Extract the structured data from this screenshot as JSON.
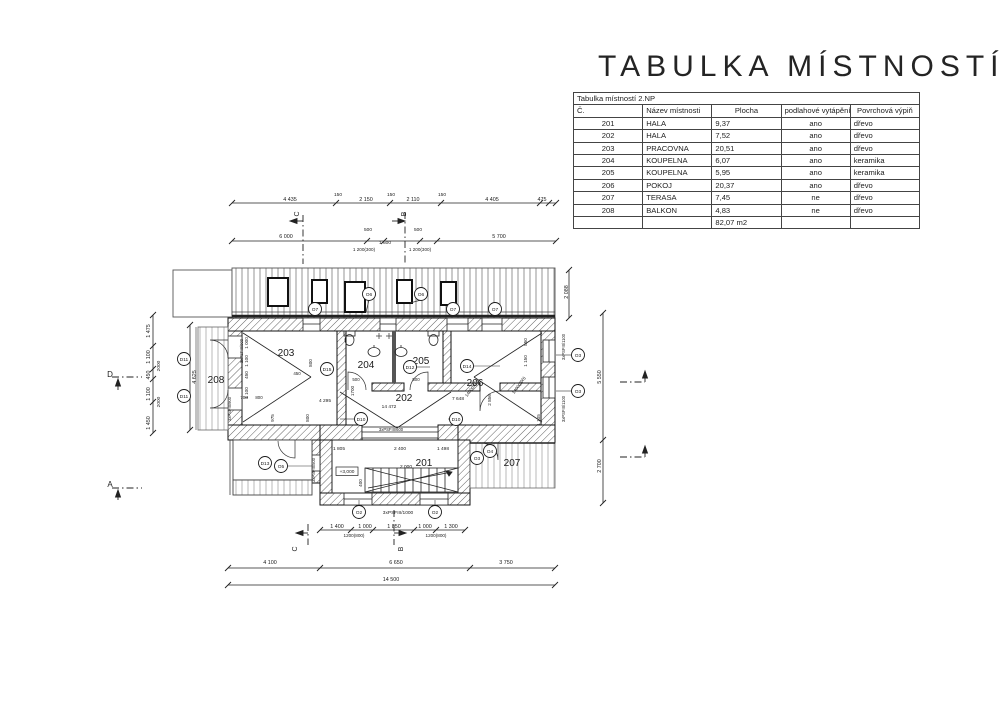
{
  "title": "TABULKA MÍSTNOSTÍ",
  "table": {
    "caption": "Tabulka místností 2.NP",
    "columns": [
      "Č.",
      "Název místnosti",
      "Plocha",
      "podlahové vytápění",
      "Povrchová výpiň"
    ],
    "rows": [
      [
        "201",
        "HALA",
        "9,37",
        "ano",
        "dřevo"
      ],
      [
        "202",
        "HALA",
        "7,52",
        "ano",
        "dřevo"
      ],
      [
        "203",
        "PRACOVNA",
        "20,51",
        "ano",
        "dřevo"
      ],
      [
        "204",
        "KOUPELNA",
        "6,07",
        "ano",
        "keramika"
      ],
      [
        "205",
        "KOUPELNA",
        "5,95",
        "ano",
        "keramika"
      ],
      [
        "206",
        "POKOJ",
        "20,37",
        "ano",
        "dřevo"
      ],
      [
        "207",
        "TERASA",
        "7,45",
        "ne",
        "dřevo"
      ],
      [
        "208",
        "BALKON",
        "4,83",
        "ne",
        "dřevo"
      ]
    ],
    "total": "82,07 m2"
  },
  "colors": {
    "highlight": "#e56fce",
    "ink": "#1a1a1a"
  },
  "plan": {
    "room_labels": [
      {
        "t": "201",
        "x": 424,
        "y": 466,
        "s": 10
      },
      {
        "t": "202",
        "x": 404,
        "y": 401,
        "s": 10
      },
      {
        "t": "203",
        "x": 286,
        "y": 356,
        "s": 10
      },
      {
        "t": "204",
        "x": 366,
        "y": 368,
        "s": 10
      },
      {
        "t": "205",
        "x": 421,
        "y": 364,
        "s": 10
      },
      {
        "t": "206",
        "x": 475,
        "y": 386,
        "s": 10
      },
      {
        "t": "207",
        "x": 512,
        "y": 466,
        "s": 10
      },
      {
        "t": "208",
        "x": 216,
        "y": 383,
        "s": 10
      }
    ],
    "labels": [
      {
        "t": "4 435",
        "x": 290,
        "y": 201
      },
      {
        "t": "150",
        "x": 338,
        "y": 196,
        "s": 4.8
      },
      {
        "t": "2 150",
        "x": 366,
        "y": 201
      },
      {
        "t": "150",
        "x": 391,
        "y": 196,
        "s": 4.8
      },
      {
        "t": "2 110",
        "x": 413,
        "y": 201
      },
      {
        "t": "150",
        "x": 442,
        "y": 196,
        "s": 4.8
      },
      {
        "t": "4 405",
        "x": 492,
        "y": 201
      },
      {
        "t": "475",
        "x": 542,
        "y": 201
      },
      {
        "t": "6 000",
        "x": 286,
        "y": 238
      },
      {
        "t": "500",
        "x": 368,
        "y": 231,
        "s": 4.8
      },
      {
        "t": "1 600",
        "x": 385,
        "y": 244,
        "s": 4.8
      },
      {
        "t": "500",
        "x": 418,
        "y": 231,
        "s": 4.8
      },
      {
        "t": "5 700",
        "x": 499,
        "y": 238
      },
      {
        "t": "1 200(300)",
        "x": 364,
        "y": 251,
        "s": 4.6
      },
      {
        "t": "1 200(300)",
        "x": 420,
        "y": 251,
        "s": 4.6
      },
      {
        "t": "C",
        "x": 299,
        "y": 214,
        "s": 7,
        "r": -90
      },
      {
        "t": "B",
        "x": 406,
        "y": 214,
        "s": 7,
        "r": -90
      },
      {
        "t": "C",
        "x": 297,
        "y": 549,
        "s": 7,
        "r": -90
      },
      {
        "t": "B",
        "x": 403,
        "y": 549,
        "s": 7,
        "r": -90
      },
      {
        "t": "D",
        "x": 110,
        "y": 377,
        "s": 8
      },
      {
        "t": "A",
        "x": 110,
        "y": 487,
        "s": 8
      },
      {
        "t": "1 475",
        "x": 150,
        "y": 331,
        "r": -90
      },
      {
        "t": "1 100",
        "x": 150,
        "y": 357,
        "r": -90
      },
      {
        "t": "450",
        "x": 150,
        "y": 375,
        "r": -90
      },
      {
        "t": "1 100",
        "x": 150,
        "y": 394,
        "r": -90
      },
      {
        "t": "1 450",
        "x": 150,
        "y": 423,
        "r": -90
      },
      {
        "t": "2000",
        "x": 160,
        "y": 366,
        "r": -90,
        "s": 4.8
      },
      {
        "t": "2000",
        "x": 160,
        "y": 402,
        "r": -90,
        "s": 4.8
      },
      {
        "t": "4 625",
        "x": 196,
        "y": 377,
        "r": -90
      },
      {
        "t": "2 088",
        "x": 568,
        "y": 292,
        "r": -90
      },
      {
        "t": "5 550",
        "x": 601,
        "y": 377,
        "r": -90
      },
      {
        "t": "2 700",
        "x": 601,
        "y": 466,
        "r": -90
      },
      {
        "t": "1 805",
        "x": 339,
        "y": 450,
        "s": 4.8
      },
      {
        "t": "2 400",
        "x": 400,
        "y": 450,
        "s": 4.8
      },
      {
        "t": "1 498",
        "x": 443,
        "y": 450,
        "s": 4.8
      },
      {
        "t": "2 000",
        "x": 406,
        "y": 468,
        "s": 4.8
      },
      {
        "t": "400",
        "x": 362,
        "y": 483,
        "r": -90,
        "s": 4.6
      },
      {
        "t": "+3,000",
        "x": 347,
        "y": 473,
        "s": 4.8
      },
      {
        "t": "1 400",
        "x": 337,
        "y": 528
      },
      {
        "t": "1 000",
        "x": 365,
        "y": 528
      },
      {
        "t": "1 850",
        "x": 394,
        "y": 528
      },
      {
        "t": "1 000",
        "x": 425,
        "y": 528
      },
      {
        "t": "1 300",
        "x": 451,
        "y": 528
      },
      {
        "t": "1200(800)",
        "x": 354,
        "y": 537,
        "s": 4.6
      },
      {
        "t": "1200(800)",
        "x": 436,
        "y": 537,
        "s": 4.6
      },
      {
        "t": "4 100",
        "x": 270,
        "y": 564
      },
      {
        "t": "6 650",
        "x": 396,
        "y": 564
      },
      {
        "t": "3 750",
        "x": 506,
        "y": 564
      },
      {
        "t": "14 500",
        "x": 391,
        "y": 581
      },
      {
        "t": "1 000",
        "x": 248,
        "y": 343,
        "r": -90,
        "s": 4.6
      },
      {
        "t": "1 100",
        "x": 248,
        "y": 361,
        "r": -90,
        "s": 4.6
      },
      {
        "t": "450",
        "x": 248,
        "y": 375,
        "r": -90,
        "s": 4.6
      },
      {
        "t": "1 100",
        "x": 248,
        "y": 393,
        "r": -90,
        "s": 4.6
      },
      {
        "t": "800",
        "x": 312,
        "y": 363,
        "r": -90,
        "s": 4.6
      },
      {
        "t": "450",
        "x": 297,
        "y": 375,
        "s": 4.4
      },
      {
        "t": "708",
        "x": 244,
        "y": 399,
        "s": 4.4
      },
      {
        "t": "800",
        "x": 259,
        "y": 399,
        "s": 4.4
      },
      {
        "t": "975",
        "x": 274,
        "y": 418,
        "r": -90,
        "s": 4.6
      },
      {
        "t": "800",
        "x": 309,
        "y": 418,
        "r": -90,
        "s": 4.6
      },
      {
        "t": "1700",
        "x": 354,
        "y": 391,
        "r": -90,
        "s": 4.6
      },
      {
        "t": "4 295",
        "x": 325,
        "y": 402,
        "s": 4.8
      },
      {
        "t": "14 472",
        "x": 389,
        "y": 408,
        "s": 4.8
      },
      {
        "t": "500",
        "x": 356,
        "y": 381,
        "s": 4.4
      },
      {
        "t": "500",
        "x": 416,
        "y": 381,
        "s": 4.4
      },
      {
        "t": "7 648",
        "x": 458,
        "y": 400,
        "s": 4.8
      },
      {
        "t": "2 856",
        "x": 491,
        "y": 400,
        "r": -90,
        "s": 4.6
      },
      {
        "t": "850",
        "x": 527,
        "y": 342,
        "r": -90,
        "s": 4.6
      },
      {
        "t": "1 150",
        "x": 527,
        "y": 361,
        "r": -90,
        "s": 4.6
      },
      {
        "t": "1400(800)",
        "x": 520,
        "y": 386,
        "r": -55,
        "s": 4.4
      },
      {
        "t": "1400(800)",
        "x": 473,
        "y": 389,
        "r": -55,
        "s": 4.4
      },
      {
        "t": "1 105",
        "x": 540,
        "y": 420,
        "r": -90,
        "s": 4.6
      },
      {
        "t": "3xPSFIII/900",
        "x": 243,
        "y": 351,
        "r": -90,
        "s": 4.2
      },
      {
        "t": "3xPSFIII/900",
        "x": 231,
        "y": 409,
        "r": -90,
        "s": 4.2
      },
      {
        "t": "3xPSFIII/1100",
        "x": 565,
        "y": 347,
        "r": -90,
        "s": 4.2
      },
      {
        "t": "3xPSFIII/1100",
        "x": 565,
        "y": 409,
        "r": -90,
        "s": 4.2
      },
      {
        "t": "3xPSFIII/500",
        "x": 315,
        "y": 470,
        "r": -90,
        "s": 4.2
      },
      {
        "t": "3xPSFIII/1000",
        "x": 398,
        "y": 514,
        "s": 4.8
      },
      {
        "t": "3xPSFIII/600",
        "x": 391,
        "y": 431,
        "s": 4.2
      }
    ],
    "circles": [
      {
        "t": "O7",
        "x": 315,
        "y": 309
      },
      {
        "t": "O6",
        "x": 369,
        "y": 294
      },
      {
        "t": "O6",
        "x": 421,
        "y": 294
      },
      {
        "t": "O7",
        "x": 453,
        "y": 309
      },
      {
        "t": "O7",
        "x": 495,
        "y": 309
      },
      {
        "t": "D11",
        "x": 184,
        "y": 359
      },
      {
        "t": "D11",
        "x": 184,
        "y": 396
      },
      {
        "t": "D15",
        "x": 327,
        "y": 369
      },
      {
        "t": "D12",
        "x": 410,
        "y": 367
      },
      {
        "t": "D14",
        "x": 467,
        "y": 366
      },
      {
        "t": "D10",
        "x": 361,
        "y": 419
      },
      {
        "t": "D10",
        "x": 456,
        "y": 419
      },
      {
        "t": "D13",
        "x": 265,
        "y": 463
      },
      {
        "t": "O5",
        "x": 281,
        "y": 466
      },
      {
        "t": "O3",
        "x": 477,
        "y": 458
      },
      {
        "t": "O4",
        "x": 490,
        "y": 451
      },
      {
        "t": "O3",
        "x": 578,
        "y": 355
      },
      {
        "t": "O3",
        "x": 578,
        "y": 391
      },
      {
        "t": "O2",
        "x": 359,
        "y": 512
      },
      {
        "t": "O2",
        "x": 435,
        "y": 512
      }
    ]
  }
}
